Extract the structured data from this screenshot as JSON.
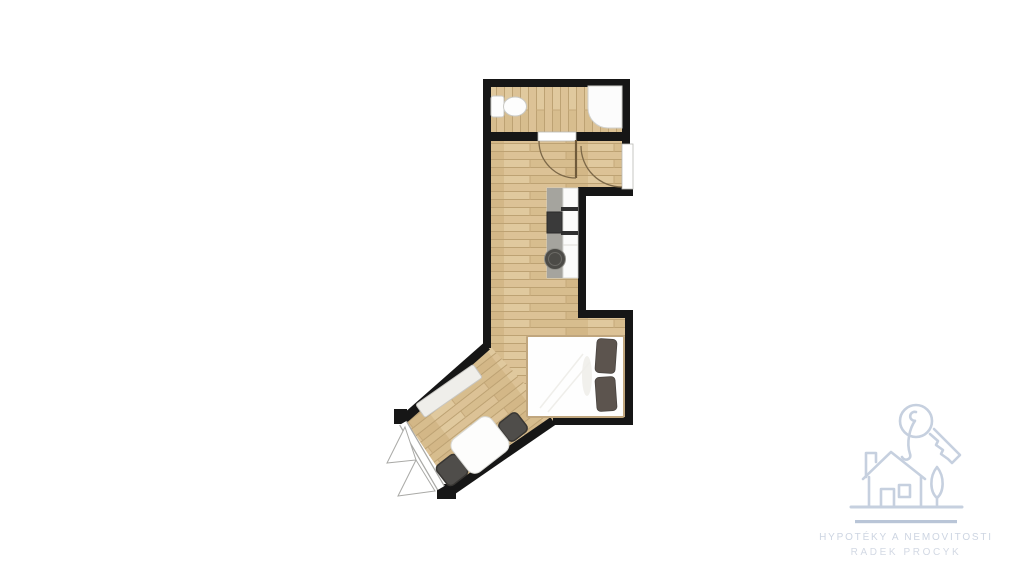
{
  "watermark": {
    "brand_line1": "HYPOTÉKY A NEMOVITOSTI",
    "brand_line2": "RADEK PROCYK",
    "icon": "house-key-tree-logo",
    "stroke_color": "#c6d0df",
    "underline_color": "#b9c5d7"
  },
  "palette": {
    "background": "#ffffff",
    "wall": "#161616",
    "wood_base": "#d9c094",
    "wood_seam": "#bda273",
    "wood_joint": "#c6a97a",
    "fixture_white": "#fcfcfc",
    "fixture_outline": "#cfcfcb",
    "counter_gray": "#a5a49e",
    "appliance_dark": "#3a3a3a",
    "sink_dark": "#4c4b47",
    "chair_gray": "#4f4d4a",
    "pillow_taupe": "#5c544e",
    "bed_frame_tan": "#c0a67e",
    "door_arc_brown": "#7c6848",
    "window_frame_gray": "#a9a9a6"
  },
  "plan": {
    "type": "studio-apartment-floor-plan",
    "rooms": [
      "bathroom",
      "hallway-kitchenette",
      "entry-vestibule",
      "bedroom-dining-area"
    ],
    "fixtures": [
      "toilet",
      "shower-tray",
      "bathroom-door-swing",
      "entry-door-swing",
      "kitchen-counter",
      "cooktop",
      "round-sink",
      "double-bed",
      "pillow-left",
      "pillow-right",
      "bench",
      "dining-table",
      "dining-chair-upper",
      "dining-chair-lower",
      "casement-window-bay"
    ]
  }
}
